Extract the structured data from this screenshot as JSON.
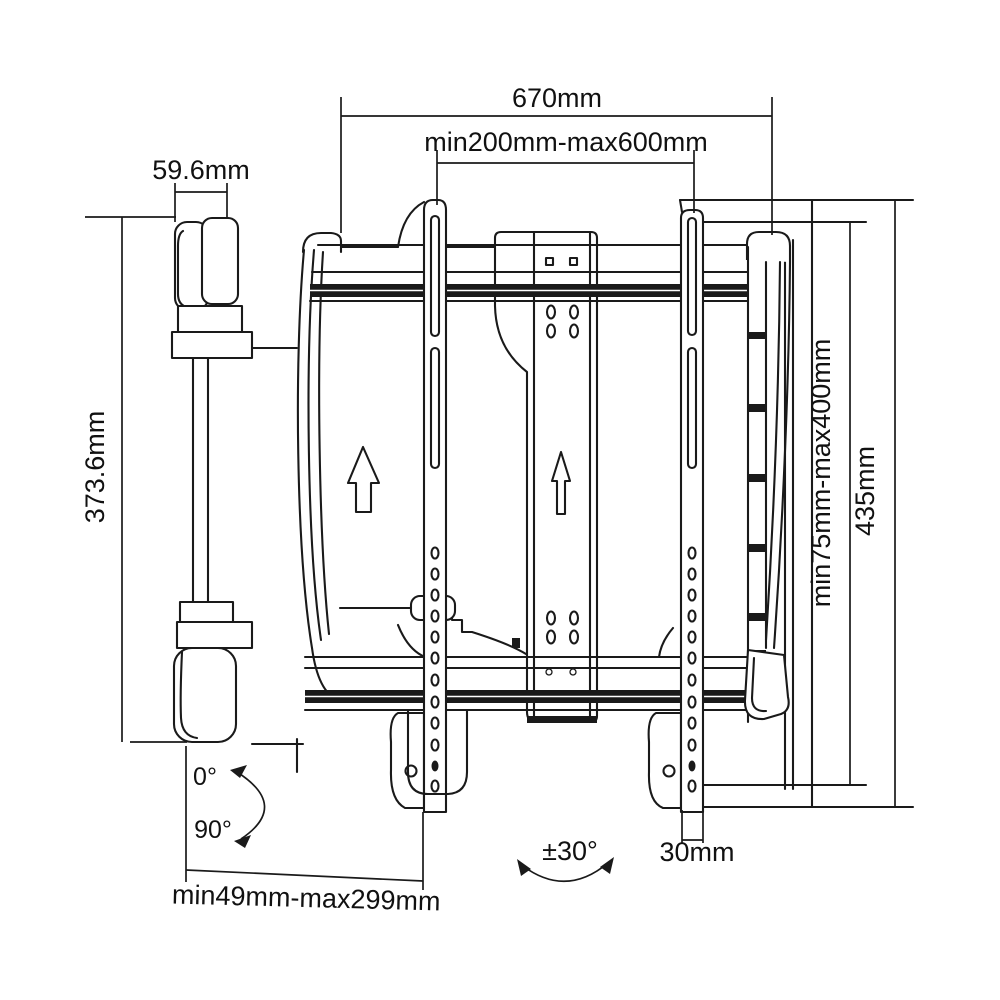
{
  "page": {
    "background": "#ffffff",
    "line_color": "#1a1a1a",
    "description": "Technical dimension drawing of an articulating TV wall mount bracket, side view"
  },
  "drawing_labels": {
    "total_width": "670mm",
    "vesa_width_range": "min200mm-max600mm",
    "arm_thickness": "59.6mm",
    "arm_height": "373.6mm",
    "vesa_height_range": "min75mm-max400mm",
    "bracket_height": "435mm",
    "extension_range": "min49mm-max299mm",
    "rail_width": "30mm",
    "swivel_range": "±30°",
    "tilt_min": "0°",
    "tilt_max": "90°"
  },
  "symbols": {
    "up_arrow_large": "orientation arrow up",
    "up_arrow_small": "orientation arrow up",
    "swivel_arc": "swivel rotation arc",
    "tilt_arc": "tilt rotation arc"
  }
}
